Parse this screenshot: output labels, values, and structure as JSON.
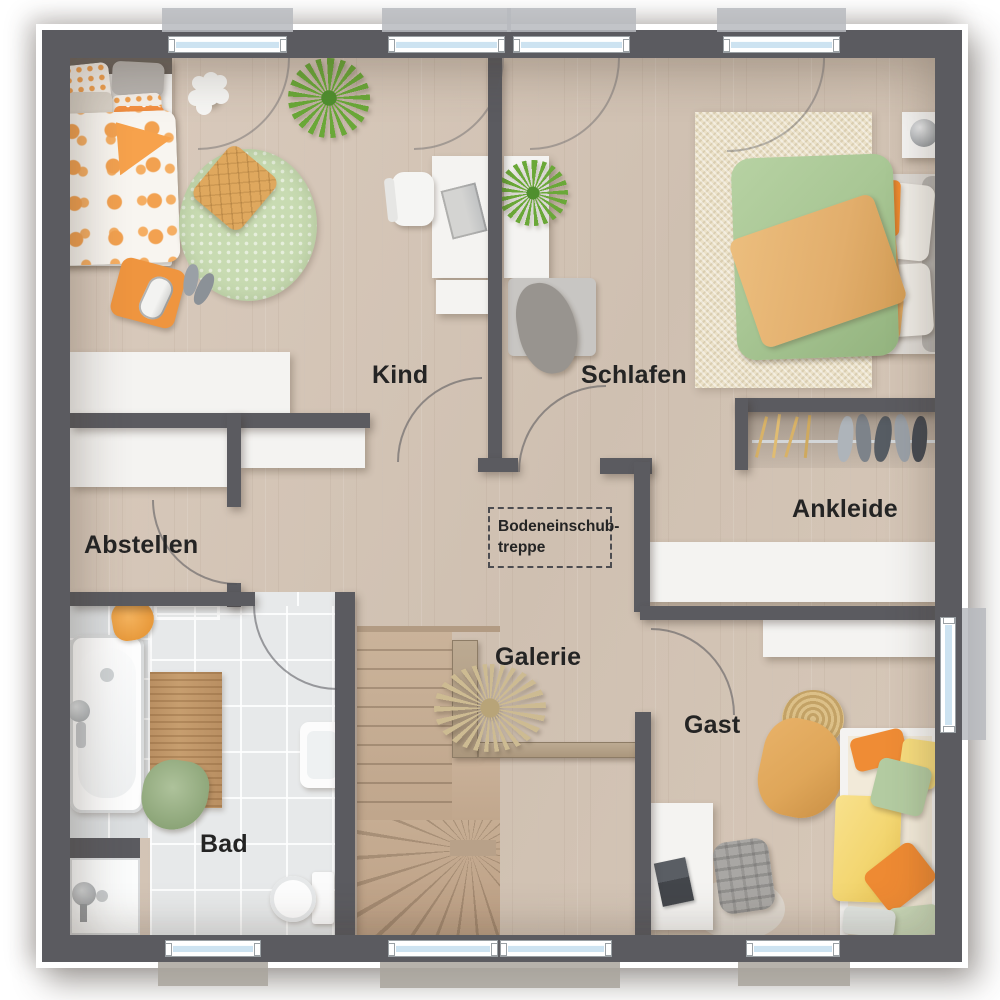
{
  "plan": {
    "rooms": {
      "kind": {
        "label": "Kind"
      },
      "schlafen": {
        "label": "Schlafen"
      },
      "abstellen": {
        "label": "Abstellen"
      },
      "ankleide": {
        "label": "Ankleide"
      },
      "bad": {
        "label": "Bad"
      },
      "galerie": {
        "label": "Galerie"
      },
      "gast": {
        "label": "Gast"
      }
    },
    "annotations": {
      "attic_stairs": {
        "line1": "Bodeneinschub-",
        "line2": "treppe"
      }
    },
    "palette": {
      "wall": "#5b5b60",
      "floor": "#d5c6b7",
      "tile": "#e7e9ea",
      "tiledark": "#dcdfe1",
      "white": "#f4f3f1",
      "stair": "#c7b098",
      "rail": "#b5a28b",
      "glass": "#cde3f1",
      "sill": "#b7babe",
      "ink": "#242424",
      "ruggreen": "#c8dbb2",
      "rugbeige": "#ebe1c8",
      "duvetgreen": "#a9c795",
      "ochre": "#e2ae6c",
      "orange": "#ef953f",
      "matwood": "#c79e6f",
      "plantgreen": "#6aa838",
      "plantdry": "#cdbb92",
      "gastcream": "#f2ead9",
      "gastyellow": "#f3d671",
      "wicker": "#d3b57f"
    }
  }
}
